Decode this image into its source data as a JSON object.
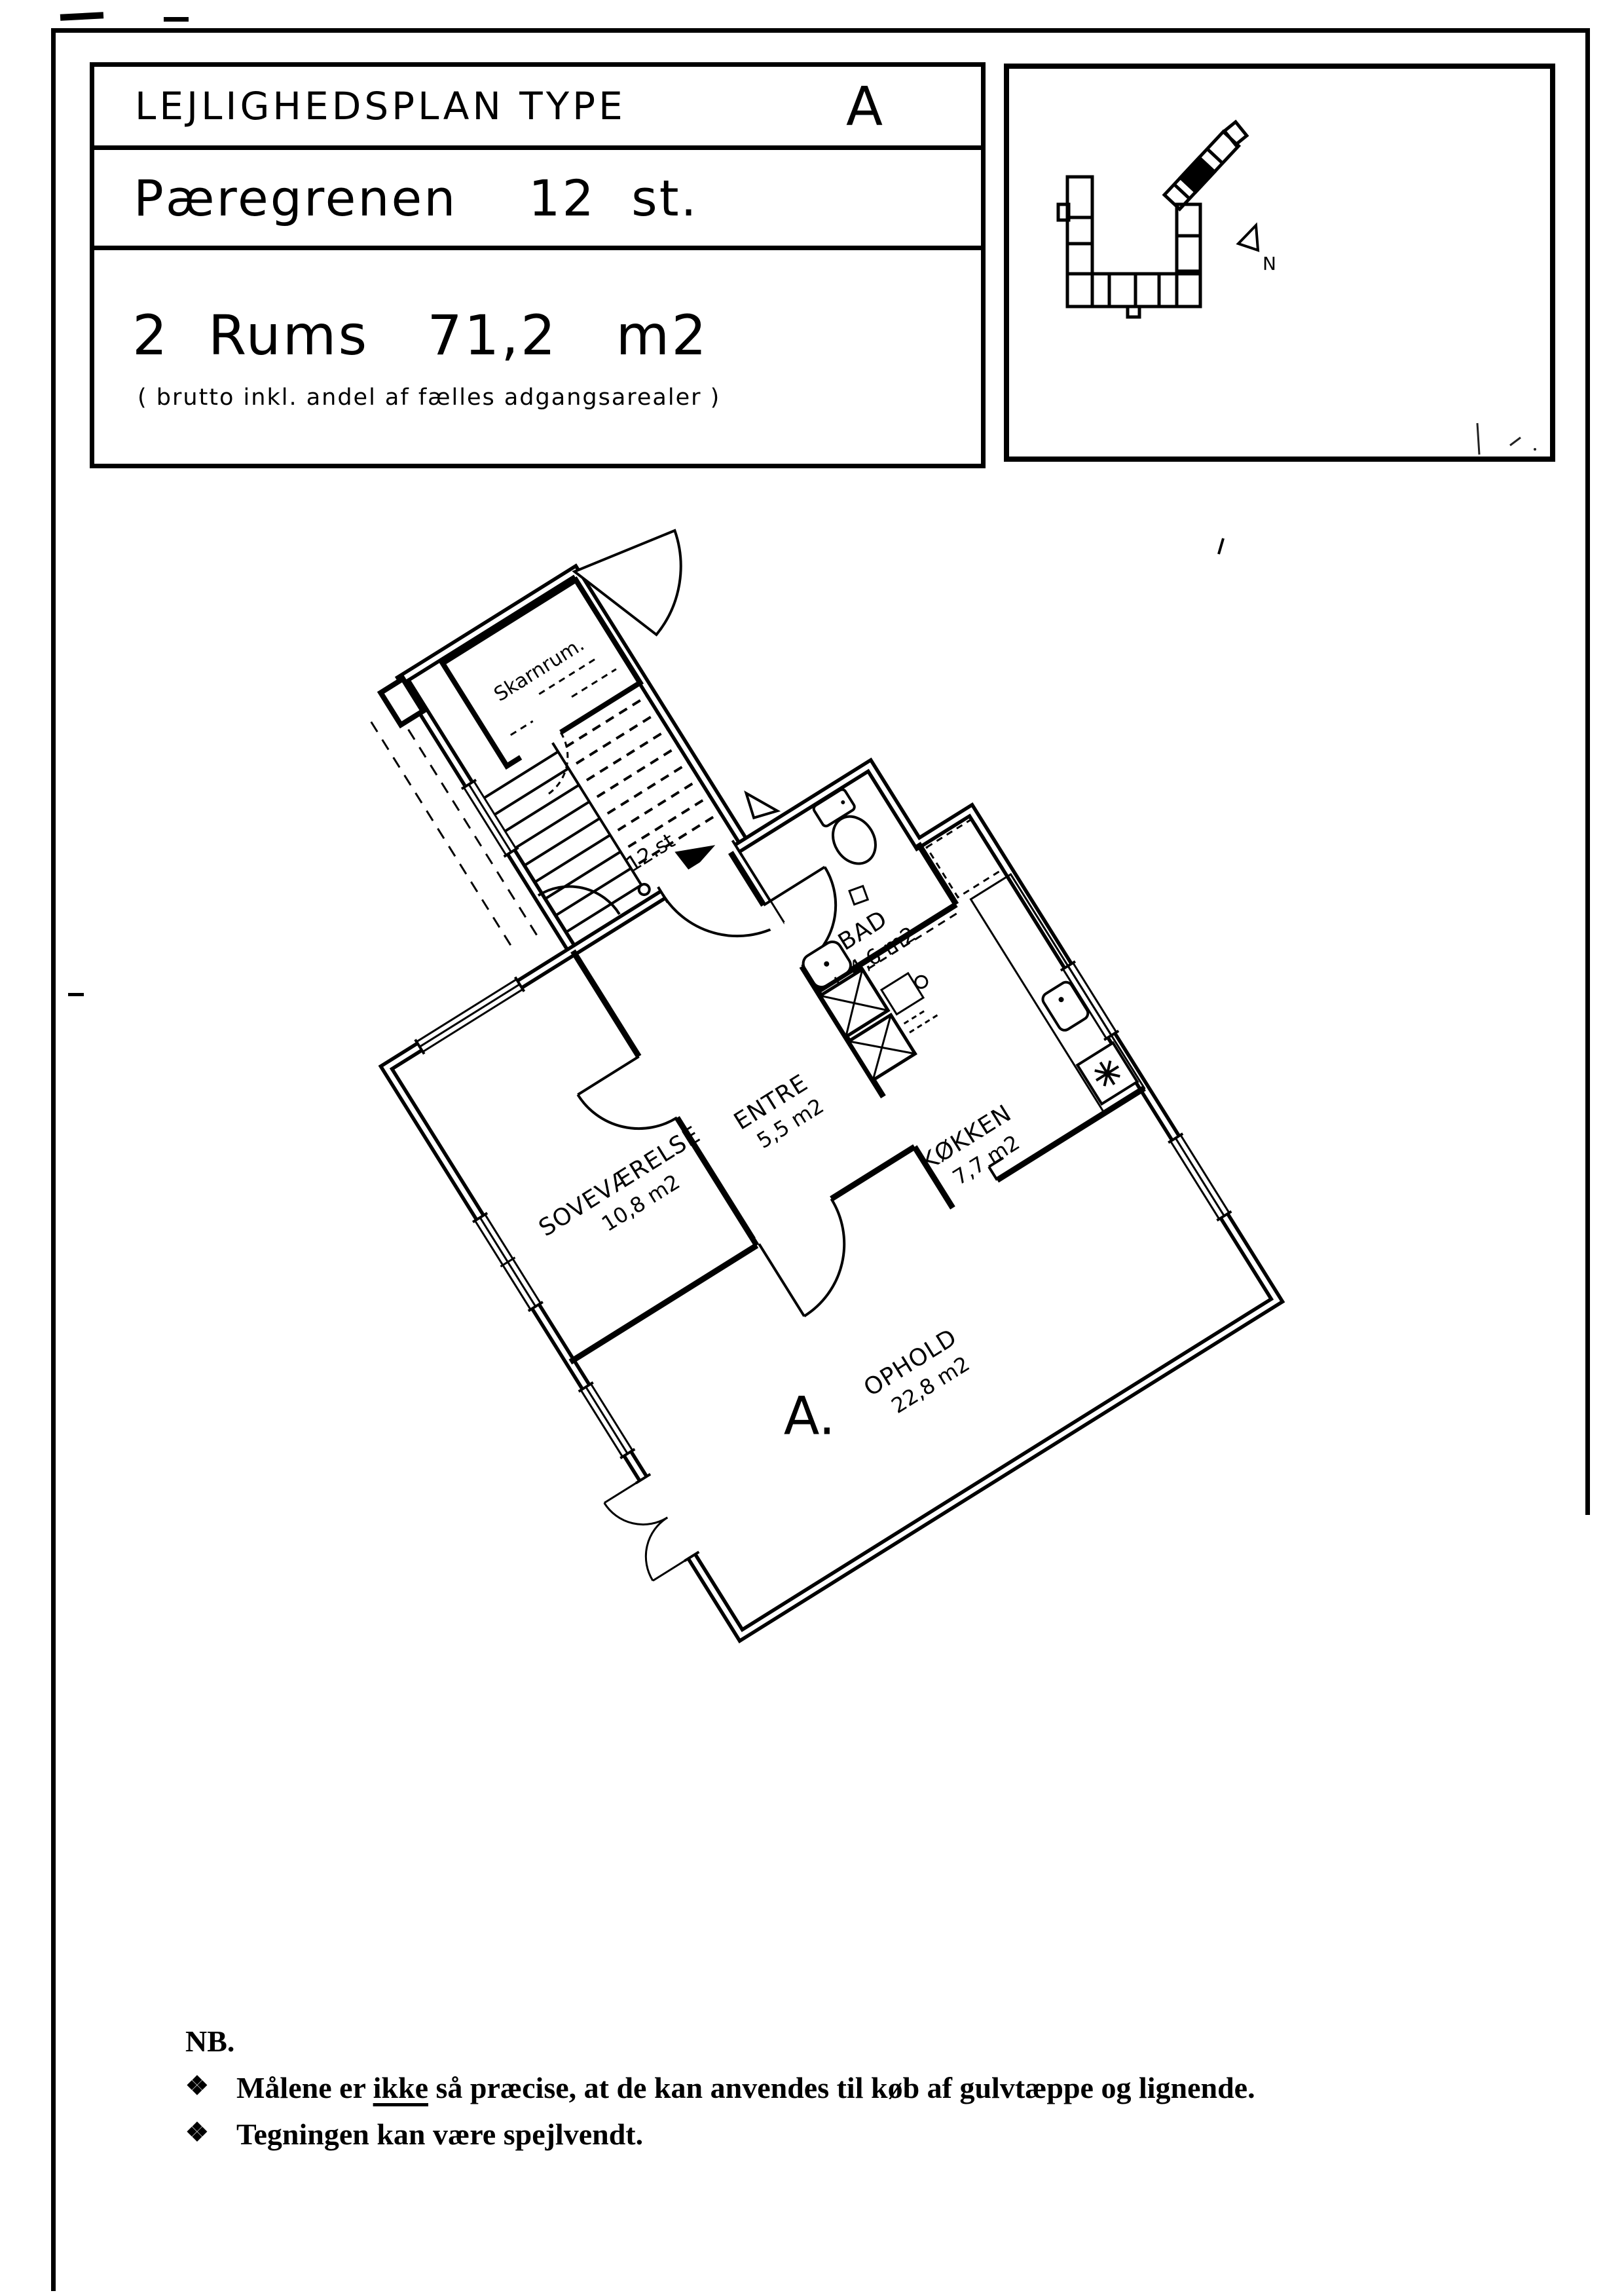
{
  "title_block": {
    "row1_label": "LEJLIGHEDSPLAN TYPE",
    "row1_type": "A",
    "row2_text": "Pæregrenen    12  st.",
    "row3_text": "2  Rums   71,2   m2",
    "row3_note": "( brutto inkl. andel af fælles adgangsarealer )"
  },
  "site_map": {
    "north_label": "N"
  },
  "floor_plan": {
    "stair_room_label": "Skarnrum.",
    "floor_label": "12.st",
    "apartment_letter": "A.",
    "rooms": {
      "bad": {
        "name": "BAD",
        "area": "4,6 m2"
      },
      "entre": {
        "name": "ENTRE",
        "area": "5,5 m2"
      },
      "sovevaerelse": {
        "name": "SOVEVÆRELSE",
        "area": "10,8 m2"
      },
      "koekken": {
        "name": "KØKKEN",
        "area": "7,7 m2"
      },
      "ophold": {
        "name": "OPHOLD",
        "area": "22,8 m2"
      }
    }
  },
  "notes": {
    "heading": "NB.",
    "bullet": "❖",
    "item1_pre": "Målene er ",
    "item1_underlined": "ikke",
    "item1_post": " så præcise, at de kan anvendes til køb af gulvtæppe og lignende.",
    "item2": "Tegningen kan være spejlvendt."
  }
}
